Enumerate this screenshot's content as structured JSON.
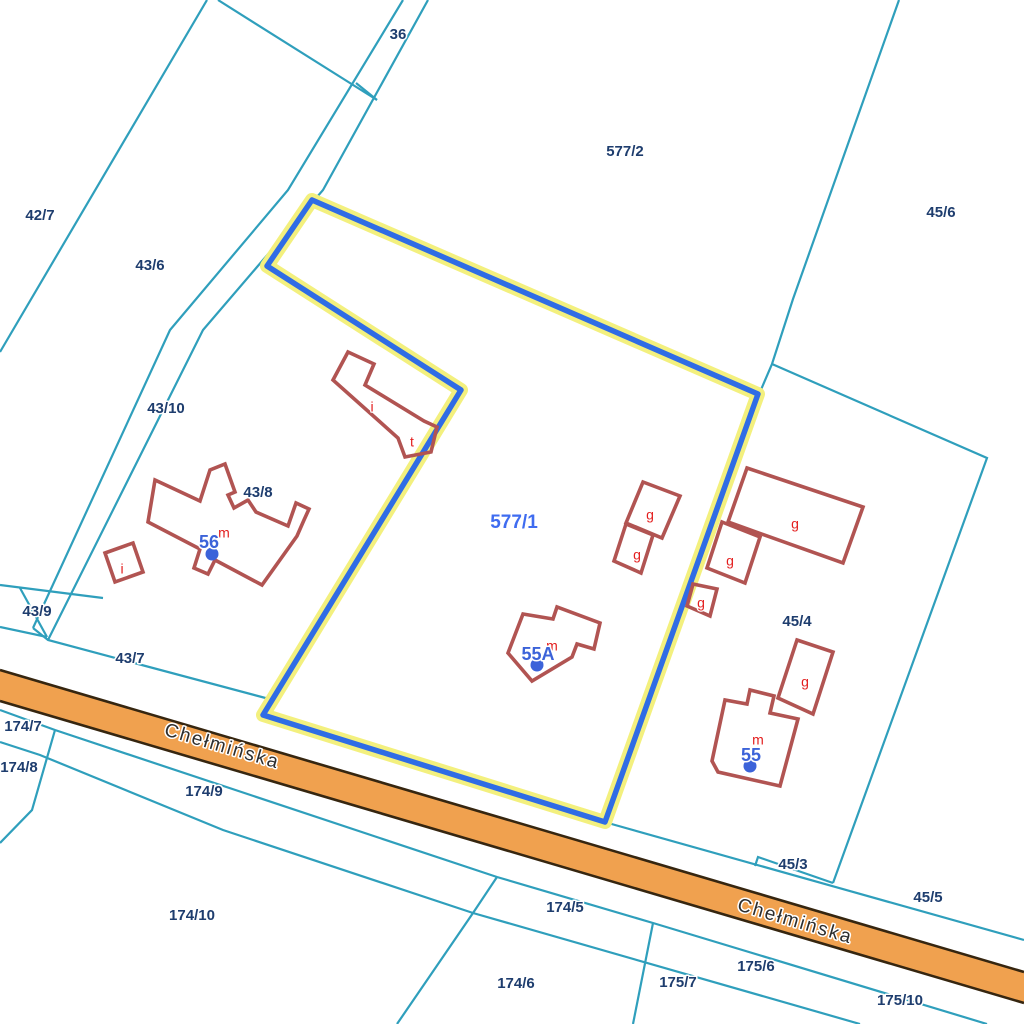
{
  "map": {
    "background": "#ffffff",
    "palette": {
      "parcel_line": "#2f9fbc",
      "parcel_label": "#1e3d6e",
      "selected_halo": "#f3f07e",
      "selected_stroke": "#2f6ce5",
      "selected_label": "#3f6cf0",
      "building_stroke": "#b15452",
      "building_letter": "#e31e1e",
      "address_color": "#3c63d9",
      "road_fill": "#f0a14f",
      "road_border": "#362610",
      "road_label": "#2d2d2d"
    },
    "road": {
      "name": "Chełmińska",
      "top_edge": [
        [
          0,
          670
        ],
        [
          1024,
          972
        ]
      ],
      "bottom_edge": [
        [
          0,
          701
        ],
        [
          1024,
          1003
        ]
      ],
      "labels": [
        {
          "text": "Chełmińska",
          "x": 222,
          "y": 747,
          "angle": 16.4
        },
        {
          "text": "Chełmińska",
          "x": 795,
          "y": 922,
          "angle": 16.4
        }
      ]
    },
    "parcel_boundaries": [
      {
        "points": [
          [
            207,
            0
          ],
          [
            0,
            352
          ]
        ]
      },
      {
        "points": [
          [
            218,
            0
          ],
          [
            377,
            100
          ]
        ]
      },
      {
        "points": [
          [
            403,
            0
          ],
          [
            288,
            190
          ],
          [
            170,
            330
          ],
          [
            33,
            628
          ]
        ]
      },
      {
        "points": [
          [
            428,
            0
          ],
          [
            323,
            190
          ],
          [
            203,
            330
          ],
          [
            48,
            640
          ]
        ]
      },
      {
        "points": [
          [
            356,
            83
          ],
          [
            377,
            100
          ]
        ]
      },
      {
        "points": [
          [
            899,
            0
          ],
          [
            793,
            299
          ],
          [
            772,
            364
          ],
          [
            760,
            392
          ]
        ]
      },
      {
        "points": [
          [
            772,
            364
          ],
          [
            987,
            458
          ],
          [
            833,
            883
          ]
        ]
      },
      {
        "points": [
          [
            0,
            585
          ],
          [
            103,
            598
          ]
        ]
      },
      {
        "points": [
          [
            0,
            627
          ],
          [
            47,
            637
          ]
        ]
      },
      {
        "points": [
          [
            20,
            588
          ],
          [
            47,
            637
          ]
        ]
      },
      {
        "points": [
          [
            33,
            628
          ],
          [
            48,
            640
          ],
          [
            273,
            700
          ]
        ]
      },
      {
        "points": [
          [
            608,
            823
          ],
          [
            1024,
            940
          ]
        ]
      },
      {
        "points": [
          [
            755,
            866
          ],
          [
            758,
            857
          ],
          [
            833,
            883
          ]
        ]
      },
      {
        "points": [
          [
            0,
            710
          ],
          [
            55,
            730
          ],
          [
            497,
            877
          ],
          [
            653,
            923
          ],
          [
            987,
            1024
          ]
        ]
      },
      {
        "points": [
          [
            0,
            742
          ],
          [
            40,
            755
          ],
          [
            223,
            830
          ],
          [
            473,
            913
          ],
          [
            860,
            1024
          ]
        ]
      },
      {
        "points": [
          [
            55,
            730
          ],
          [
            32,
            810
          ],
          [
            0,
            843
          ]
        ]
      },
      {
        "points": [
          [
            497,
            877
          ],
          [
            473,
            913
          ],
          [
            397,
            1024
          ]
        ]
      },
      {
        "points": [
          [
            653,
            923
          ],
          [
            633,
            1024
          ]
        ]
      }
    ],
    "parcel_labels": [
      {
        "text": "36",
        "x": 398,
        "y": 35
      },
      {
        "text": "42/7",
        "x": 40,
        "y": 216
      },
      {
        "text": "43/6",
        "x": 150,
        "y": 266
      },
      {
        "text": "577/2",
        "x": 625,
        "y": 152
      },
      {
        "text": "45/6",
        "x": 941,
        "y": 213
      },
      {
        "text": "43/10",
        "x": 166,
        "y": 409
      },
      {
        "text": "43/8",
        "x": 258,
        "y": 493
      },
      {
        "text": "45/4",
        "x": 797,
        "y": 622
      },
      {
        "text": "43/9",
        "x": 37,
        "y": 612
      },
      {
        "text": "43/7",
        "x": 130,
        "y": 659
      },
      {
        "text": "174/7",
        "x": 23,
        "y": 727
      },
      {
        "text": "174/8",
        "x": 19,
        "y": 768
      },
      {
        "text": "174/9",
        "x": 204,
        "y": 792
      },
      {
        "text": "174/10",
        "x": 192,
        "y": 916
      },
      {
        "text": "174/5",
        "x": 565,
        "y": 908
      },
      {
        "text": "174/6",
        "x": 516,
        "y": 984
      },
      {
        "text": "45/3",
        "x": 793,
        "y": 865
      },
      {
        "text": "45/5",
        "x": 928,
        "y": 898
      },
      {
        "text": "175/6",
        "x": 756,
        "y": 967
      },
      {
        "text": "175/7",
        "x": 678,
        "y": 983
      },
      {
        "text": "175/10",
        "x": 900,
        "y": 1001
      }
    ],
    "selected_parcel": {
      "id": "577/1",
      "points": [
        [
          312,
          200
        ],
        [
          758,
          394
        ],
        [
          605,
          822
        ],
        [
          263,
          715
        ],
        [
          461,
          390
        ],
        [
          267,
          266
        ]
      ],
      "label": {
        "text": "577/1",
        "x": 514,
        "y": 523
      }
    },
    "buildings": [
      {
        "points": [
          [
            348,
            352
          ],
          [
            374,
            364
          ],
          [
            365,
            385
          ],
          [
            424,
            421
          ],
          [
            437,
            427
          ],
          [
            431,
            452
          ],
          [
            405,
            457
          ],
          [
            398,
            438
          ],
          [
            333,
            380
          ]
        ]
      },
      {
        "points": [
          [
            155,
            480
          ],
          [
            200,
            501
          ],
          [
            210,
            470
          ],
          [
            225,
            464
          ],
          [
            235,
            492
          ],
          [
            228,
            495
          ],
          [
            234,
            508
          ],
          [
            248,
            500
          ],
          [
            256,
            512
          ],
          [
            288,
            526
          ],
          [
            296,
            503
          ],
          [
            309,
            509
          ],
          [
            304,
            520
          ],
          [
            297,
            536
          ],
          [
            262,
            585
          ],
          [
            215,
            560
          ],
          [
            208,
            574
          ],
          [
            194,
            568
          ],
          [
            200,
            549
          ],
          [
            148,
            522
          ]
        ]
      },
      {
        "points": [
          [
            105,
            553
          ],
          [
            133,
            543
          ],
          [
            143,
            572
          ],
          [
            115,
            582
          ]
        ]
      },
      {
        "points": [
          [
            523,
            614
          ],
          [
            553,
            619
          ],
          [
            557,
            607
          ],
          [
            600,
            623
          ],
          [
            594,
            649
          ],
          [
            577,
            644
          ],
          [
            572,
            657
          ],
          [
            532,
            681
          ],
          [
            508,
            653
          ]
        ]
      },
      {
        "points": [
          [
            643,
            482
          ],
          [
            680,
            496
          ],
          [
            662,
            538
          ],
          [
            626,
            523
          ]
        ]
      },
      {
        "points": [
          [
            626,
            524
          ],
          [
            653,
            535
          ],
          [
            641,
            573
          ],
          [
            614,
            561
          ]
        ]
      },
      {
        "points": [
          [
            747,
            468
          ],
          [
            863,
            507
          ],
          [
            843,
            563
          ],
          [
            728,
            522
          ]
        ]
      },
      {
        "points": [
          [
            722,
            522
          ],
          [
            760,
            537
          ],
          [
            745,
            583
          ],
          [
            707,
            568
          ]
        ]
      },
      {
        "points": [
          [
            693,
            584
          ],
          [
            717,
            589
          ],
          [
            710,
            616
          ],
          [
            687,
            606
          ]
        ]
      },
      {
        "points": [
          [
            797,
            640
          ],
          [
            833,
            652
          ],
          [
            813,
            714
          ],
          [
            778,
            698
          ]
        ]
      },
      {
        "points": [
          [
            712,
            761
          ],
          [
            725,
            700
          ],
          [
            747,
            704
          ],
          [
            750,
            690
          ],
          [
            774,
            696
          ],
          [
            770,
            713
          ],
          [
            798,
            719
          ],
          [
            780,
            786
          ],
          [
            718,
            772
          ]
        ]
      }
    ],
    "building_letters": [
      {
        "text": "i",
        "x": 372,
        "y": 408
      },
      {
        "text": "t",
        "x": 412,
        "y": 443
      },
      {
        "text": "i",
        "x": 122,
        "y": 570
      },
      {
        "text": "m",
        "x": 224,
        "y": 534
      },
      {
        "text": "m",
        "x": 552,
        "y": 647
      },
      {
        "text": "m",
        "x": 758,
        "y": 741
      },
      {
        "text": "g",
        "x": 650,
        "y": 516
      },
      {
        "text": "g",
        "x": 637,
        "y": 556
      },
      {
        "text": "g",
        "x": 795,
        "y": 525
      },
      {
        "text": "g",
        "x": 730,
        "y": 562
      },
      {
        "text": "g",
        "x": 701,
        "y": 604
      },
      {
        "text": "g",
        "x": 805,
        "y": 683
      }
    ],
    "address_points": [
      {
        "text": "56",
        "x": 209,
        "y": 543,
        "dot_x": 212,
        "dot_y": 554
      },
      {
        "text": "55A",
        "x": 538,
        "y": 655,
        "dot_x": 537,
        "dot_y": 665
      },
      {
        "text": "55",
        "x": 751,
        "y": 756,
        "dot_x": 750,
        "dot_y": 766
      }
    ]
  }
}
